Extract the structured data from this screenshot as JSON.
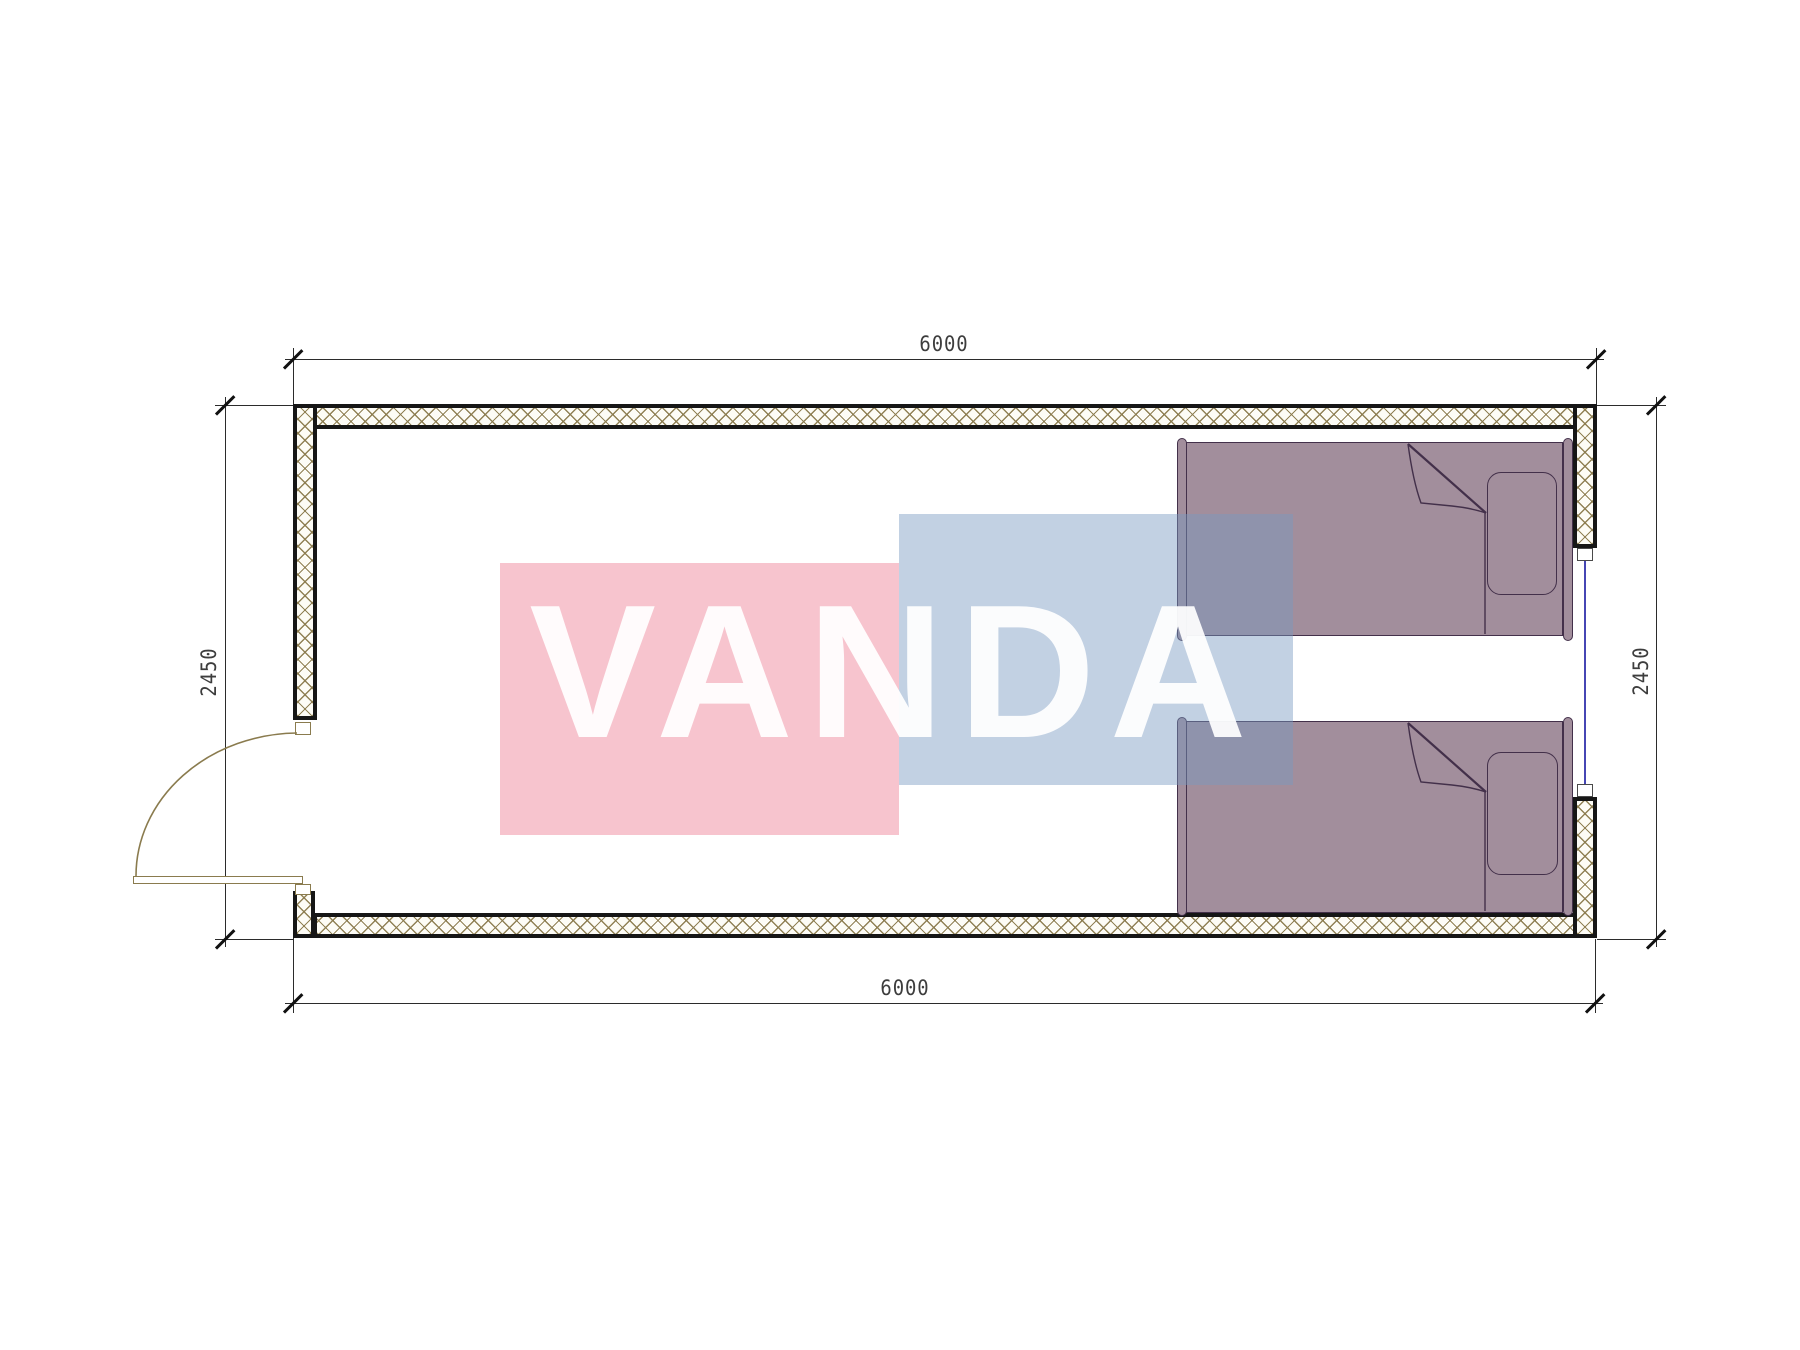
{
  "watermark": {
    "text": "VANDA",
    "pink_color": "#ed7c92",
    "blue_color": "#7799c2",
    "text_color": "#ffffff"
  },
  "dimensions": {
    "top_label": "6000",
    "bottom_label": "6000",
    "left_label": "2450",
    "right_label": "2450"
  },
  "colors": {
    "wall_hatch": "#8b7b4e",
    "wall_border": "#161616",
    "dim_line": "#2b2b2b",
    "dim_text": "#3d3d3d",
    "door_line": "#8a7b4e",
    "window_glass": "#4646b4",
    "bed_fill": "#a28e9c",
    "bed_stroke": "#43304a"
  }
}
